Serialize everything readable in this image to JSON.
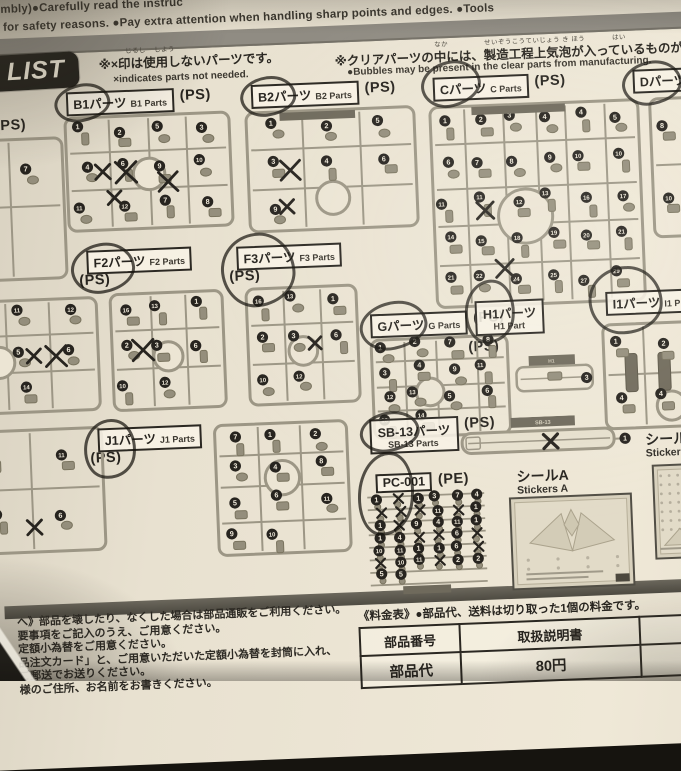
{
  "colors": {
    "paper": "#ece5d4",
    "ink": "#27241f",
    "runner_gray": "#9c9685",
    "part_fill": "#948e7c",
    "badge_bg": "#24221c",
    "gray_bar": "#908c83",
    "divider": "#57544b",
    "pen": "#17150f"
  },
  "top": {
    "line1": "mbly)●Carefully read the instruc",
    "line2": "for safety reasons. ●Pay extra attention when handling sharp points and edges.  ●Tools",
    "clear_note_jp": "※クリアパーツの中には、製造工程上気泡が入っているものがありますが",
    "clear_note_furigana": [
      "なか",
      "せいぞうこうていじょう き ほう",
      "はい"
    ],
    "clear_note_en": "●Bubbles may be present in the clear parts from manufacturing."
  },
  "list_header": {
    "badge": "LIST",
    "note_jp": "※×印は使用しないパーツです。",
    "note_furigana": [
      "じるし",
      "しよう"
    ],
    "note_en": "×indicates parts not needed."
  },
  "runners": [
    {
      "id": "A",
      "mat": "(PS)",
      "mat_pos": [
        -10,
        118
      ],
      "box": [
        -28,
        136,
        88,
        148
      ],
      "kind": "lattice",
      "cut": "left",
      "numbers": [
        13,
        7,
        10
      ],
      "crosses": 0,
      "hub": false
    },
    {
      "id": "B1",
      "jp": "B1パーツ",
      "en": "B1 Parts",
      "mat": "(PS)",
      "mat_side": "right",
      "label_pos": [
        62,
        95
      ],
      "pen": [
        50,
        87,
        50,
        32,
        -8
      ],
      "box": [
        56,
        117,
        172,
        121
      ],
      "kind": "lattice",
      "numbers": [
        1,
        2,
        5,
        3,
        4,
        6,
        9,
        10,
        11,
        12,
        7,
        8
      ],
      "crosses": 4,
      "hub": true,
      "hub_y": 0.52
    },
    {
      "id": "B2",
      "jp": "B2パーツ",
      "en": "B2 Parts",
      "mat": "(PS)",
      "mat_side": "right",
      "label_pos": [
        247,
        95
      ],
      "pen": [
        236,
        87,
        50,
        34,
        -6
      ],
      "box": [
        237,
        119,
        176,
        127
      ],
      "kind": "lattice",
      "numbers": [
        1,
        2,
        5,
        3,
        4,
        6,
        9
      ],
      "crosses": 2,
      "hub": true,
      "hub_y": 0.74,
      "topbar": true
    },
    {
      "id": "C",
      "jp": "Cパーツ",
      "en": "C Parts",
      "mat": "(PS)",
      "mat_side": "right",
      "label_pos": [
        429,
        95
      ],
      "pen": [
        417,
        79,
        54,
        40,
        -12
      ],
      "box": [
        421,
        121,
        216,
        208
      ],
      "kind": "lattice",
      "numbers": [
        1,
        2,
        3,
        4,
        4,
        5,
        6,
        7,
        8,
        9,
        10,
        10,
        11,
        11,
        12,
        13,
        16,
        17,
        14,
        15,
        18,
        19,
        20,
        21,
        21,
        22,
        24,
        25,
        27,
        29
      ],
      "crosses": 2,
      "hub": true,
      "hub_x": 0.44,
      "hub_y": 0.56,
      "topbar": true
    },
    {
      "id": "D",
      "jp": "Dパーツ",
      "en": "",
      "mat": "",
      "label_pos": [
        629,
        95
      ],
      "pen": [
        618,
        87,
        54,
        38,
        -8
      ],
      "box": [
        641,
        121,
        68,
        146
      ],
      "kind": "lattice",
      "cut": "right",
      "numbers": [
        8,
        9,
        10
      ],
      "crosses": 0,
      "hub": false
    },
    {
      "id": "E1",
      "box": [
        -28,
        297,
        116,
        120
      ],
      "kind": "lattice",
      "cut": "left",
      "numbers": [
        16,
        11,
        12,
        4,
        5,
        6,
        7,
        14
      ],
      "crosses": 2,
      "hub": true,
      "hub_x": 0.28
    },
    {
      "id": "F2",
      "jp": "F2パーツ",
      "en": "F2 Parts",
      "mat": "(PS)",
      "mat_side": "below",
      "label_pos": [
        76,
        254
      ],
      "pen": [
        60,
        247,
        58,
        44,
        -8
      ],
      "box": [
        94,
        295,
        120,
        124
      ],
      "kind": "lattice",
      "numbers": [
        16,
        13,
        1,
        2,
        3,
        6,
        10,
        12
      ],
      "crosses": 1,
      "hub": true
    },
    {
      "id": "F3",
      "jp": "F3パーツ",
      "en": "F3 Parts",
      "mat": "(PS)",
      "mat_side": "below",
      "label_pos": [
        226,
        256
      ],
      "pen": [
        210,
        243,
        68,
        68,
        -5
      ],
      "box": [
        230,
        295,
        118,
        124
      ],
      "kind": "lattice",
      "numbers": [
        16,
        13,
        1,
        2,
        3,
        6,
        10,
        12
      ],
      "crosses": 1,
      "hub": true
    },
    {
      "id": "G",
      "jp": "Gパーツ",
      "en": "G Parts",
      "mat": "(PS)",
      "mat_side": "right",
      "label_pos": [
        357,
        329
      ],
      "pen": [
        346,
        317,
        62,
        42,
        -10
      ],
      "box": [
        353,
        351,
        144,
        106
      ],
      "kind": "lattice",
      "numbers": [
        1,
        2,
        7,
        8,
        3,
        4,
        9,
        11,
        12,
        13,
        5,
        6,
        10,
        14
      ],
      "crosses": 0,
      "hub": true,
      "hub_x": 0.42
    },
    {
      "id": "H1",
      "jp": "H1パーツ",
      "en": "H1 Part",
      "two_line": true,
      "mat": "(PS)",
      "mat_side": "below",
      "label_pos": [
        462,
        320
      ],
      "pen": [
        452,
        299,
        44,
        58,
        6
      ],
      "box": [
        497,
        376,
        84,
        40
      ],
      "kind": "tray",
      "tag": "H1",
      "numbers": [
        3
      ],
      "crosses": 0
    },
    {
      "id": "I1",
      "jp": "I1パーツ",
      "en": "I1 P",
      "mat": "",
      "label_pos": [
        593,
        316
      ],
      "pen": [
        576,
        291,
        68,
        62,
        0
      ],
      "box": [
        585,
        345,
        110,
        112
      ],
      "kind": "lattice",
      "cut": "right",
      "numbers": [
        1,
        2,
        3,
        4,
        4,
        5
      ],
      "crosses": 0,
      "hub": true,
      "hub_y": 0.8,
      "slabs": 3
    },
    {
      "id": "E2",
      "box": [
        -28,
        427,
        116,
        130
      ],
      "kind": "lattice",
      "cut": "left",
      "numbers": [
        16,
        11,
        4,
        6
      ],
      "crosses": 1,
      "hub": false
    },
    {
      "id": "J1",
      "jp": "J1パーツ",
      "en": "J1 Parts",
      "mat": "(PS)",
      "mat_side": "below",
      "label_pos": [
        80,
        432
      ],
      "pen": [
        66,
        423,
        46,
        54,
        8
      ],
      "box": [
        193,
        430,
        140,
        138
      ],
      "kind": "lattice",
      "numbers": [
        7,
        1,
        2,
        3,
        4,
        8,
        5,
        6,
        11,
        9,
        10
      ],
      "crosses": 0,
      "hub": true,
      "hub_y": 0.42
    },
    {
      "id": "SB",
      "jp": "SB-13パーツ",
      "en": "SB-13 Parts",
      "two_line": true,
      "mat": "(PS)",
      "mat_side": "right",
      "label_pos": [
        352,
        434
      ],
      "pen": [
        342,
        427,
        54,
        34,
        -8
      ],
      "box": [
        440,
        438,
        178,
        46
      ],
      "kind": "beam",
      "tag": "SB-13",
      "numbers": [
        1
      ],
      "crosses": 1
    },
    {
      "id": "PC",
      "jp": "PC-001",
      "en": "",
      "mat": "(PE)",
      "mat_side": "right",
      "label_pos": [
        356,
        489
      ],
      "pen": [
        338,
        467,
        50,
        78,
        8
      ],
      "box": [
        344,
        507,
        126,
        104
      ],
      "kind": "grid",
      "numbers": [
        1,
        1,
        3,
        7,
        4,
        11,
        1,
        1,
        9,
        4,
        11,
        1,
        1,
        4,
        6,
        10,
        11,
        1,
        1,
        6,
        10,
        11,
        2,
        2,
        5,
        5
      ],
      "crosses": 12
    },
    {
      "id": "STA",
      "kind": "sticker",
      "title_jp": "シールA",
      "title_en": "Stickers A",
      "title_pos": [
        497,
        490
      ],
      "box": [
        488,
        517,
        124,
        94
      ]
    },
    {
      "id": "STB",
      "kind": "sticker",
      "title_jp": "シールB",
      "title_en": "Stickers",
      "title_pos": [
        627,
        458
      ],
      "box": [
        632,
        490,
        52,
        96
      ],
      "vertical": true
    }
  ],
  "footer": {
    "notes": [
      "へ》部品を壊したり、なくした場合は部品通販をご利用ください。",
      "要事項をご記入のうえ、ご用意ください。",
      "定額小為替をご用意ください。",
      "品注文カード」と、ご用意いただいた定額小為替を封筒に入れ、",
      "ご郵送でお送りください。",
      "様のご住所、お名前をお書きください。"
    ],
    "price_note": "《料金表》●部品代、送料は切り取った1個の料金です。",
    "table": {
      "rows": [
        [
          "部品番号",
          "取扱説明書",
          "シール類",
          "そ"
        ],
        [
          "部品代",
          "80円",
          "各40円",
          ""
        ]
      ]
    }
  }
}
